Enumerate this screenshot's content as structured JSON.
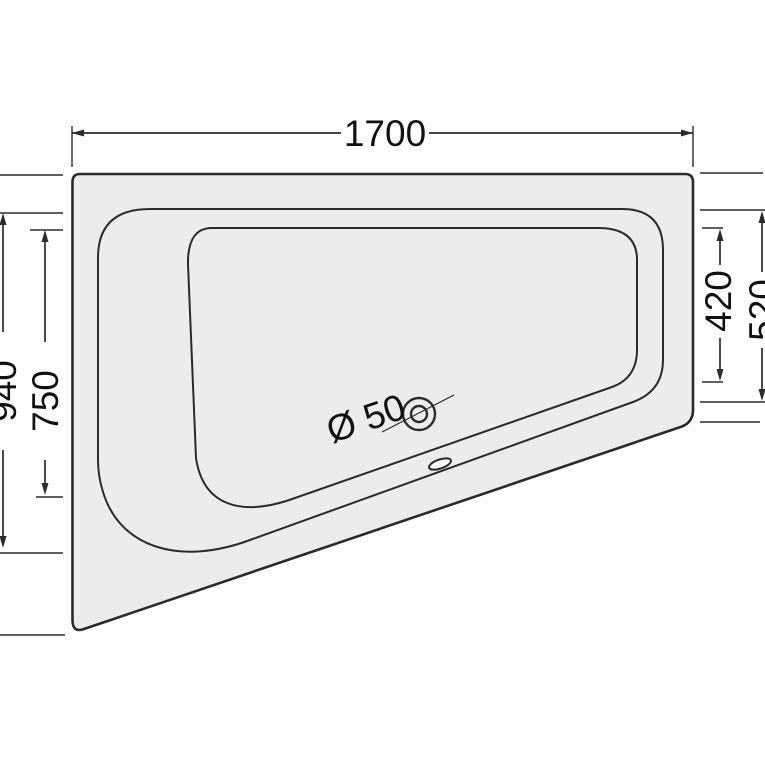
{
  "drawing": {
    "kind": "technical-drawing",
    "subject": "asymmetric corner bathtub, top view",
    "dimension_labels": {
      "overall_width": "1700",
      "left_rim_depth": "940",
      "left_floor_depth": "750",
      "right_floor_depth": "420",
      "right_rim_depth": "520",
      "drain_diameter": "Ø 50"
    },
    "colors": {
      "background": "#ffffff",
      "tub_fill": "#ececec",
      "line_color": "#2b2b2b",
      "text_color": "#111111"
    }
  }
}
